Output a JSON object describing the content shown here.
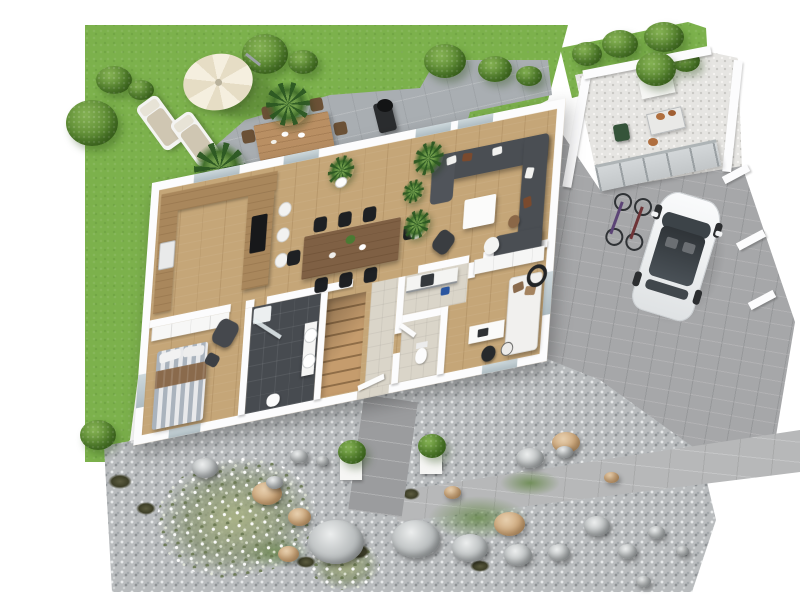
{
  "scene": {
    "type": "3d-rendered-floor-plan",
    "style": "Isometric bird's-eye 3D architectural visualization of a single-storey house with garden, patio, utility yard, driveway and gravel rock garden",
    "background_color": "#ffffff",
    "visible_text": "none"
  },
  "palette": {
    "lawn_green": "#7cb14c",
    "foliage_green": "#5d8b33",
    "patio_gray": "#a9aeb2",
    "driveway_gray": "#a6a7a9",
    "walkway_gray": "#b7b8b9",
    "gravel_gray": "#b9bcbe",
    "utility_yard_gravel": "#e6e5e2",
    "wood_floor": "#c5a678",
    "counter_wood": "#a9875c",
    "wall_white": "#fcfcfd",
    "sofa_charcoal": "#4a4e53",
    "bathroom_tile": "#474b50",
    "hall_tile_beige": "#dad5c9",
    "umbrella_cream": "#f5efdf",
    "car_white": "#f3f4f5",
    "stone_tan": "#cda97e",
    "bed_stripe_blue_gray": "#aab3bd",
    "throw_brown": "#8a6a4c"
  },
  "garden": {
    "lawn": {
      "bushes_and_trees": 13,
      "parasol": "cream 10-panel cantilever parasol",
      "sun_loungers": 2,
      "parasol_shadow": true
    },
    "patio": {
      "material": "gray pavers",
      "outdoor_dining_table_seats": 8,
      "grill": 1,
      "potted_palms": 2
    },
    "rock_garden": {
      "white_flowering_shrub": 1,
      "gray_boulders": 18,
      "tan_stones": 7,
      "dark_grass_tufts": 6,
      "ground_cover_patches": 3,
      "front_path": true,
      "boxwood_planters": 2
    }
  },
  "exterior": {
    "utility_yard": {
      "waste_bin": "green",
      "work_table": "with terracotta pots",
      "raised_planter_with_tree": 1,
      "privacy_walls": 3,
      "low_fence_to_driveway": 1
    },
    "driveway": {
      "car": "white hatchback with panoramic glass roof",
      "bicycles": 2,
      "white_wall_stubs": 3
    },
    "front_walkway": true
  },
  "house": {
    "floor": "light oak plank flooring",
    "rooms": [
      {
        "name": "kitchen",
        "features": [
          "U-shaped wood counter",
          "black cooktop island",
          "sink",
          "3 bar stools"
        ]
      },
      {
        "name": "dining area",
        "features": [
          "long wood table",
          "8 black chairs",
          "table decoration",
          "potted plant"
        ]
      },
      {
        "name": "living room",
        "features": [
          "charcoal corner sofa",
          "white and brown cushions",
          "white coffee table",
          "dark armchair",
          "white lounge chair",
          "round side table",
          "house plants",
          "glass patio doors"
        ]
      },
      {
        "name": "master bedroom",
        "features": [
          "double bed with striped duvet",
          "brown throw",
          "white wardrobe row",
          "gray armchair with ottoman"
        ]
      },
      {
        "name": "en-suite bathroom",
        "features": [
          "dark tile floor",
          "walk-in glass shower",
          "two round basins on counter",
          "wc"
        ]
      },
      {
        "name": "staircase",
        "features": [
          "wood winder stairs"
        ]
      },
      {
        "name": "entrance hall",
        "features": [
          "beige tile floor",
          "front door"
        ]
      },
      {
        "name": "guest wc",
        "features": [
          "toilet",
          "swing door"
        ]
      },
      {
        "name": "utility room",
        "features": [
          "beige tile floor",
          "counter with washing machine"
        ]
      },
      {
        "name": "office guest room",
        "features": [
          "white wardrobe",
          "white daybed with brown cushions",
          "desk with laptop",
          "black office chair",
          "round side table"
        ]
      }
    ]
  }
}
